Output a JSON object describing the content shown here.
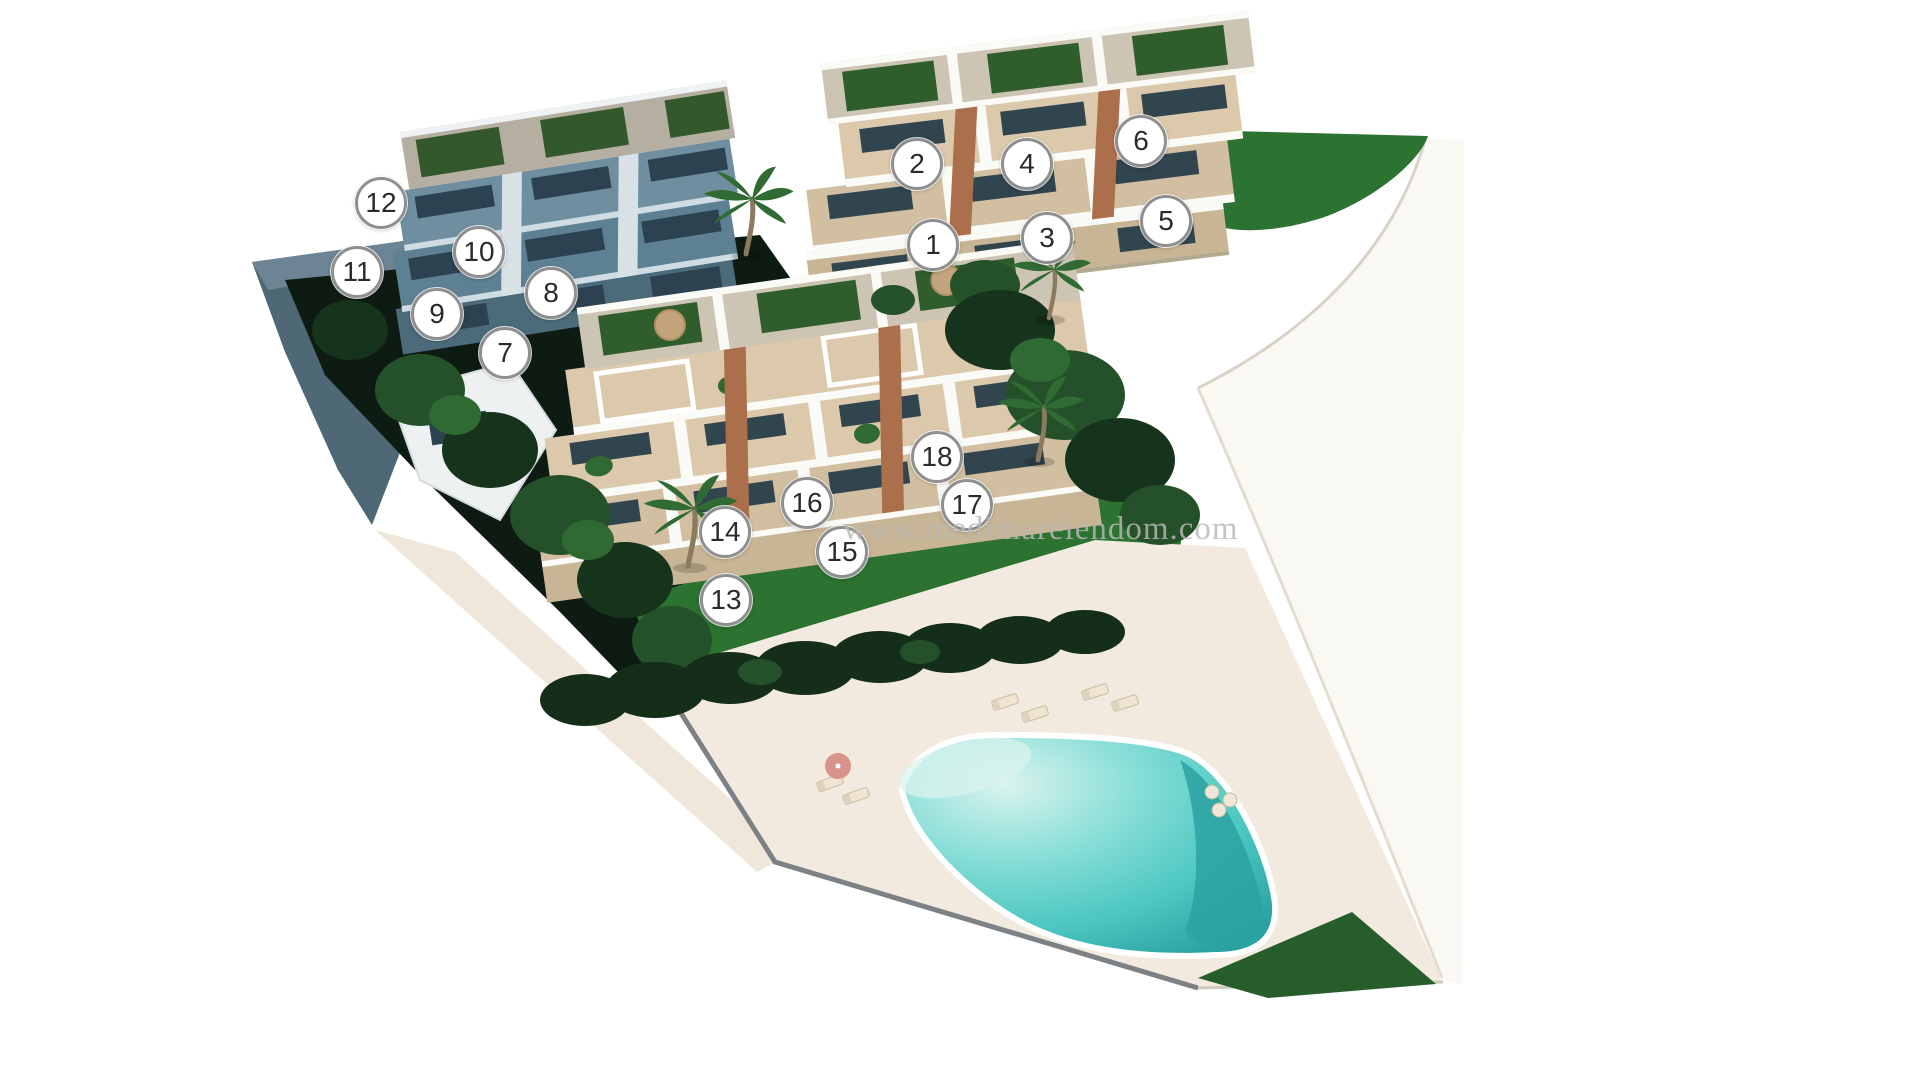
{
  "scene": {
    "type": "3d-residential-site-plan-render",
    "watermark": "www.medimareiendom.com",
    "unit_markers": [
      {
        "number": "1",
        "x": 933,
        "y": 245
      },
      {
        "number": "2",
        "x": 917,
        "y": 164
      },
      {
        "number": "3",
        "x": 1047,
        "y": 238
      },
      {
        "number": "4",
        "x": 1027,
        "y": 164
      },
      {
        "number": "5",
        "x": 1166,
        "y": 221
      },
      {
        "number": "6",
        "x": 1141,
        "y": 141
      },
      {
        "number": "7",
        "x": 505,
        "y": 353
      },
      {
        "number": "8",
        "x": 551,
        "y": 293
      },
      {
        "number": "9",
        "x": 437,
        "y": 314
      },
      {
        "number": "10",
        "x": 479,
        "y": 252
      },
      {
        "number": "11",
        "x": 357,
        "y": 272
      },
      {
        "number": "12",
        "x": 381,
        "y": 203
      },
      {
        "number": "13",
        "x": 726,
        "y": 600
      },
      {
        "number": "14",
        "x": 725,
        "y": 532
      },
      {
        "number": "15",
        "x": 842,
        "y": 552
      },
      {
        "number": "16",
        "x": 807,
        "y": 503
      },
      {
        "number": "17",
        "x": 967,
        "y": 505
      },
      {
        "number": "18",
        "x": 937,
        "y": 457
      }
    ],
    "buildings": [
      {
        "id": "building-a",
        "units": "1-6"
      },
      {
        "id": "building-b",
        "units": "7-12"
      },
      {
        "id": "building-c",
        "units": "13-18"
      }
    ],
    "features": [
      "swimming-pool",
      "pool-deck",
      "sun-loungers",
      "parasol",
      "lawns",
      "palm-trees",
      "hedge-row",
      "roof-terraces",
      "retaining-wall"
    ]
  },
  "colors": {
    "background": "#ffffff",
    "wall_white": "#fafaf7",
    "roof_deck": "#cdc5b4",
    "roof_deck_shadow": "#b5afa2",
    "roof_green": "#2f5d2b",
    "roof_green_shadow": "#33582c",
    "terrace_1": "#dcc9ac",
    "terrace_2": "#d2bfa1",
    "stone": "#c8b595",
    "glass": "#31454f",
    "stair": "#ac6f4c",
    "shadow_wall": "#4c6b7a",
    "shadow_terr": "#5e8093",
    "shadow_terr2": "#6f8fa0",
    "shadow_glass": "#2c4250",
    "shadow_stair": "#d7e1e6",
    "shadow_parapet": "#cfdde3",
    "slope_wall": "#4e6875",
    "slope_dark": "#0e1b13",
    "tree_dark": "#16331c",
    "tree_mid": "#24512a",
    "tree_light": "#2f6a33",
    "lawn": "#2c7231",
    "lawn_dark": "#275c2b",
    "hedge": "#142e1a",
    "deck": "#f2eade",
    "path": "#efe7da",
    "road": "#faf8f3",
    "pool_beach": "#daf3ee",
    "pool_light": "#8adfd8",
    "pool_mid": "#4cc7c1",
    "pool_deep": "#2aa2a1",
    "marker_bg": "#ffffff",
    "marker_ring": "#8f8f8f",
    "marker_text": "#2b2b2b",
    "watermark": "#bab8b4"
  }
}
